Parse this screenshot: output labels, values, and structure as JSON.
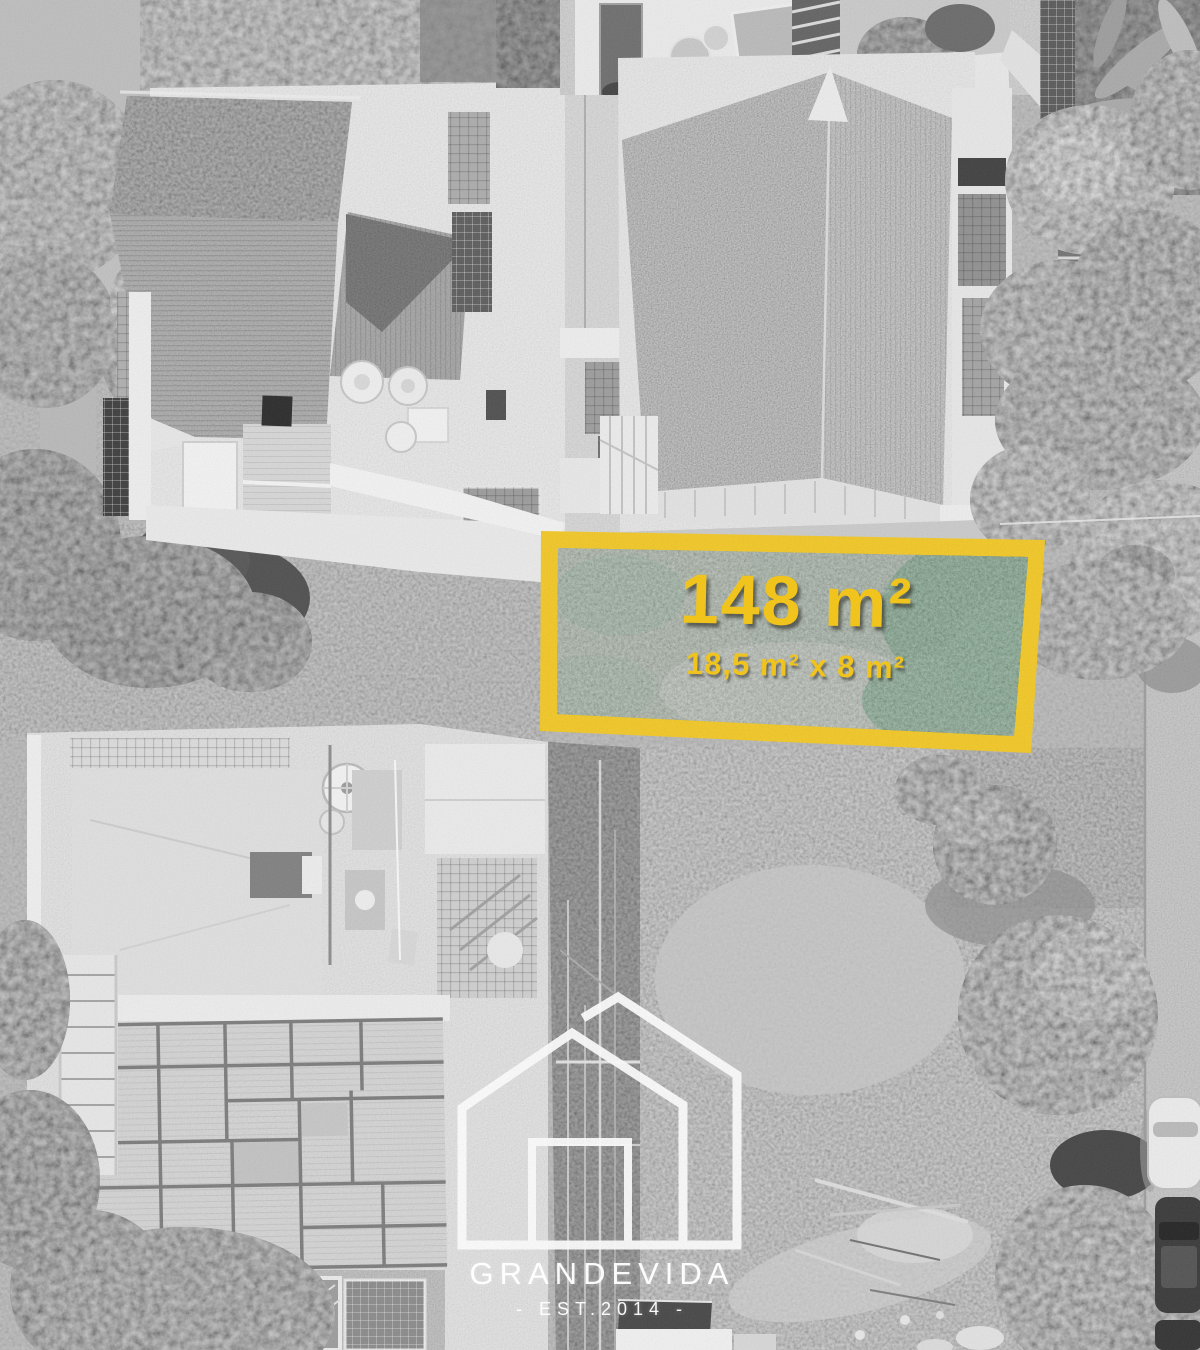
{
  "photo": {
    "style": "black-and-white aerial drone photo",
    "subject": "residential block with vacant land plot highlighted"
  },
  "plot": {
    "area": "148 m²",
    "dimensions": "18,5 m² x 8 m²",
    "border_color": "#f3c71f",
    "label_color": "#f0c41d",
    "grass_color": "#7e9a80"
  },
  "brand": {
    "name": "GRANDEVIDA",
    "established": "- EST.2014 -",
    "logo_icon": "house-outline-icon",
    "color": "#ffffff"
  }
}
